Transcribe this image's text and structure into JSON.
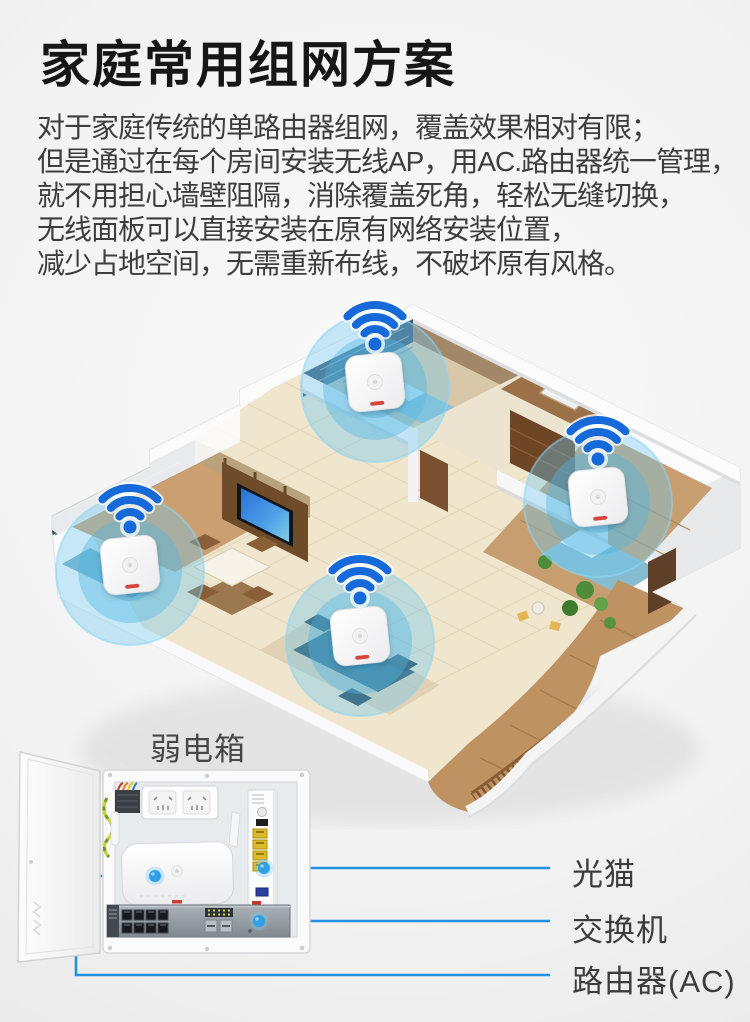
{
  "page": {
    "width": 750,
    "height": 1022
  },
  "header": {
    "title": "家庭常用组网方案",
    "paragraph_lines": [
      "对于家庭传统的单路由器组网，覆盖效果相对有限；",
      "但是通过在每个房间安装无线AP，用AC.路由器统一管理，",
      "就不用担心墙壁阻隔，消除覆盖死角，轻松无缝切换，",
      "无线面板可以直接安装在原有网络安装位置，",
      "减少占地空间，无需重新布线，不破坏原有风格。"
    ]
  },
  "floorplan": {
    "ap_count": 4,
    "icons": {
      "wifi_icon": "three blue signal arcs over a dot",
      "coverage_icon": "translucent blue coverage circle",
      "ap_device_icon": "white square wall-mount wireless AP"
    }
  },
  "cabinet": {
    "label": "弱电箱",
    "icons": {
      "connector_dot_icon": "blue callout dot",
      "devices": [
        "power-socket",
        "optical-modem",
        "router-ac",
        "network-switch"
      ]
    }
  },
  "annotations": {
    "items": [
      {
        "label": "光猫"
      },
      {
        "label": "交换机"
      },
      {
        "label": "路由器(AC)"
      }
    ]
  },
  "colors": {
    "background": "#f0f0f0",
    "title_text": "#161616",
    "body_text": "#3d3d3d",
    "label_text": "#3c3c3c",
    "wifi_blue": "#1569d9",
    "connector_blue": "#2f9fe6",
    "annotation_line_blue": "#2590df",
    "coverage_blue": "rgba(90,190,232,0.42)",
    "ap_stripe_red": "#d6453c"
  }
}
